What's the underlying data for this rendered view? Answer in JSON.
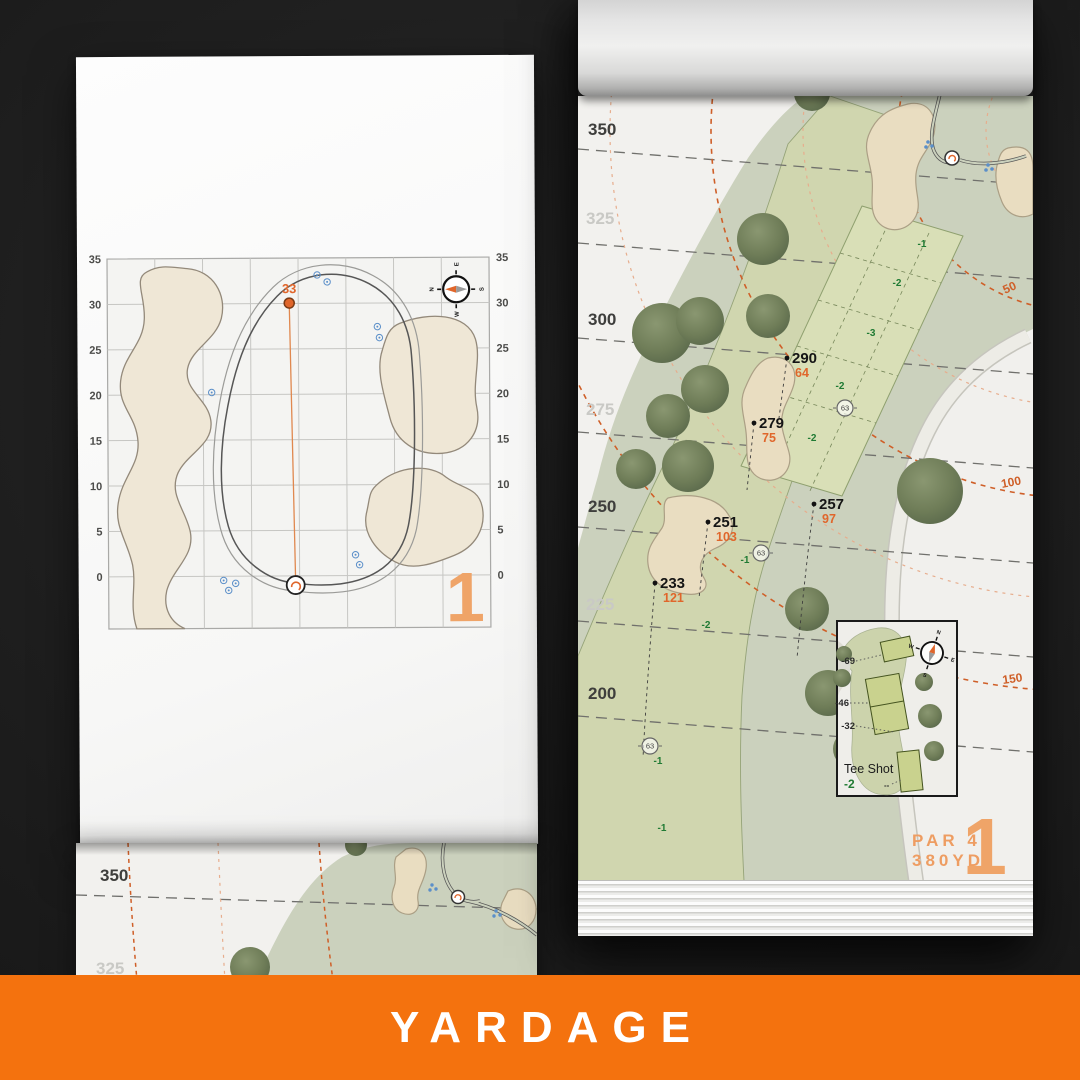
{
  "banner": {
    "label": "YARDAGE",
    "bg_color": "#F4720E",
    "text_color": "#FFFFFF"
  },
  "left_page": {
    "hole_number": "1",
    "pin_yardage": "33",
    "axis_labels": [
      "35",
      "30",
      "25",
      "20",
      "15",
      "10",
      "5",
      "0"
    ],
    "compass": {
      "n": "N",
      "e": "E",
      "s": "S",
      "w": "W"
    }
  },
  "right_page": {
    "hole_number": "1",
    "par_label": "PAR 4",
    "total_yardage": "380YD",
    "distance_labels": [
      "350",
      "325",
      "300",
      "275",
      "250",
      "225",
      "200"
    ],
    "arc_labels": [
      "50",
      "100",
      "150"
    ],
    "carry_points": [
      {
        "carry": "290",
        "remaining": "64"
      },
      {
        "carry": "279",
        "remaining": "75"
      },
      {
        "carry": "257",
        "remaining": "97"
      },
      {
        "carry": "251",
        "remaining": "103"
      },
      {
        "carry": "233",
        "remaining": "121"
      }
    ],
    "slope_numbers": [
      "-1",
      "-2",
      "-3",
      "-2",
      "-2",
      "-1",
      "-2",
      "-1",
      "-1"
    ],
    "sprinkler_number": "63",
    "tee_inset": {
      "title": "Tee Shot",
      "front_value": "-2",
      "tee_distances": [
        "-69",
        "-46",
        "-32"
      ],
      "back_marker": "--",
      "compass": {
        "n": "N",
        "e": "E",
        "s": "S",
        "w": "W"
      }
    },
    "accent_color": "#E0662B"
  },
  "under_page": {
    "distance_labels": [
      "350",
      "325"
    ]
  }
}
